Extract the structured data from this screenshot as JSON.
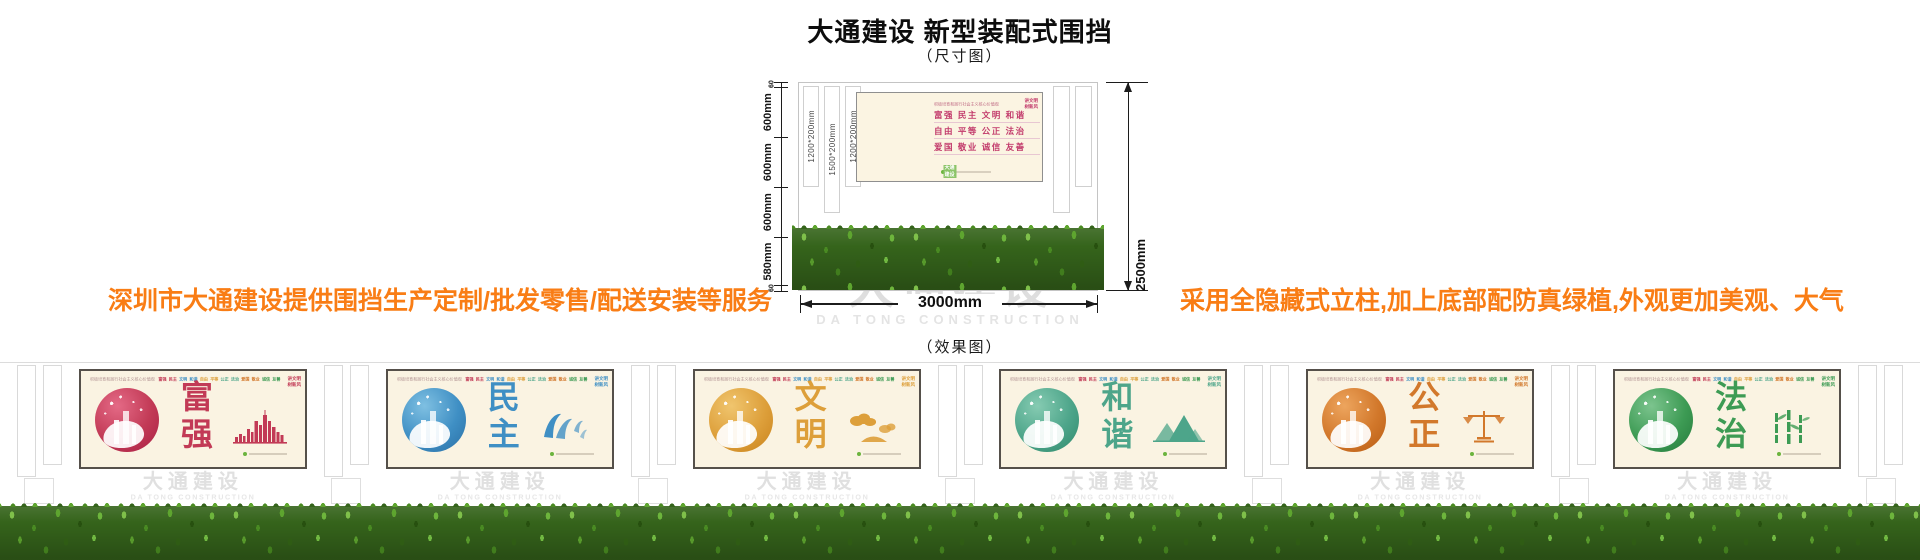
{
  "header": {
    "title": "大通建设 新型装配式围挡",
    "size_label": "（尺寸图）",
    "effect_label": "（效果图）"
  },
  "notes": {
    "left": "深圳市大通建设提供围挡生产定制/批发零售/配送安装等服务",
    "right": "采用全隐藏式立柱,加上底部配防真绿植,外观更加美观、大气",
    "color": "#f97d15"
  },
  "watermark": {
    "cn": "大通建设",
    "en": "DA TONG CONSTRUCTION"
  },
  "dimensions": {
    "left_segments": [
      {
        "label": "60",
        "mm": 60
      },
      {
        "label": "600mm",
        "mm": 600
      },
      {
        "label": "600mm",
        "mm": 600
      },
      {
        "label": "600mm",
        "mm": 600
      },
      {
        "label": "580mm",
        "mm": 580
      },
      {
        "label": "60",
        "mm": 60
      }
    ],
    "height_total": "2500mm",
    "width_total": "3000mm",
    "post_labels": [
      "1200*200mm",
      "1500*200mm",
      "1200*200mm"
    ]
  },
  "billboard": {
    "slogan": "积极培育和践行社会主义核心价值观",
    "value_rows": [
      "富强  民主  文明  和谐",
      "自由  平等  公正  法治",
      "爱国  敬业  诚信  友善"
    ],
    "corner_lines": [
      "讲文明",
      "树新风"
    ],
    "logo_cn": "大通建设",
    "circle_colors": {
      "light": "#ea7b95",
      "base": "#c22a57",
      "dark": "#8e1240"
    }
  },
  "effect": {
    "values_row": [
      "富强",
      "民主",
      "文明",
      "和谐",
      "自由",
      "平等",
      "公正",
      "法治",
      "爱国",
      "敬业",
      "诚信",
      "友善"
    ],
    "panels": [
      {
        "name": "fuqiang",
        "chars": [
          "富",
          "强"
        ],
        "color": "#c23a56",
        "circle_light": "#e46a86",
        "circle_dark": "#a91f44",
        "icon": "skyline"
      },
      {
        "name": "minzhu",
        "chars": [
          "民",
          "主"
        ],
        "color": "#3f8fc4",
        "circle_light": "#7fc0e2",
        "circle_dark": "#2a6fa5",
        "icon": "doves"
      },
      {
        "name": "wenming",
        "chars": [
          "文",
          "明"
        ],
        "color": "#dd9f3a",
        "circle_light": "#f0c56e",
        "circle_dark": "#c9821c",
        "icon": "clouds"
      },
      {
        "name": "hexie",
        "chars": [
          "和",
          "谐"
        ],
        "color": "#4da58a",
        "circle_light": "#86cbb2",
        "circle_dark": "#2f8a6c",
        "icon": "mountains"
      },
      {
        "name": "gongzheng",
        "chars": [
          "公",
          "正"
        ],
        "color": "#d2782b",
        "circle_light": "#eda55e",
        "circle_dark": "#b85c14",
        "icon": "scale"
      },
      {
        "name": "fazhi",
        "chars": [
          "法",
          "治"
        ],
        "color": "#3d9b54",
        "circle_light": "#7cc48e",
        "circle_dark": "#257a3c",
        "icon": "bamboo"
      }
    ]
  }
}
